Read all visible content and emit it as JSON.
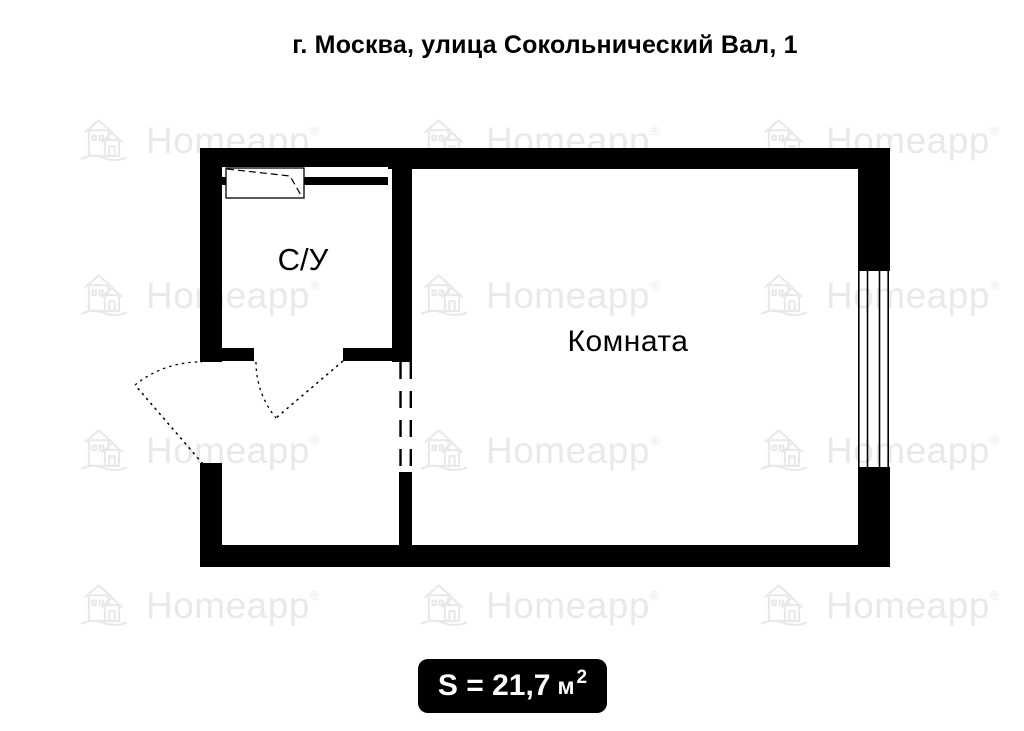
{
  "title": "г. Москва, улица Сокольнический Вал, 1",
  "watermark": {
    "text": "Homeapp",
    "registered_mark": "®",
    "color": "#e9e9e9",
    "icon": "homeapp-houses-logo"
  },
  "plan": {
    "rooms": [
      {
        "name": "С/У",
        "type": "bathroom"
      },
      {
        "name": "Комната",
        "type": "living-room"
      }
    ]
  },
  "area": {
    "full_label": "S = 21,7 м²",
    "prefix": "S = 21,7",
    "unit": "м",
    "sup": "2"
  },
  "colors": {
    "walls": "#000000",
    "background": "#ffffff",
    "badge_background": "#000000",
    "badge_text": "#ffffff",
    "watermark": "#e9e9e9",
    "text": "#000000"
  }
}
